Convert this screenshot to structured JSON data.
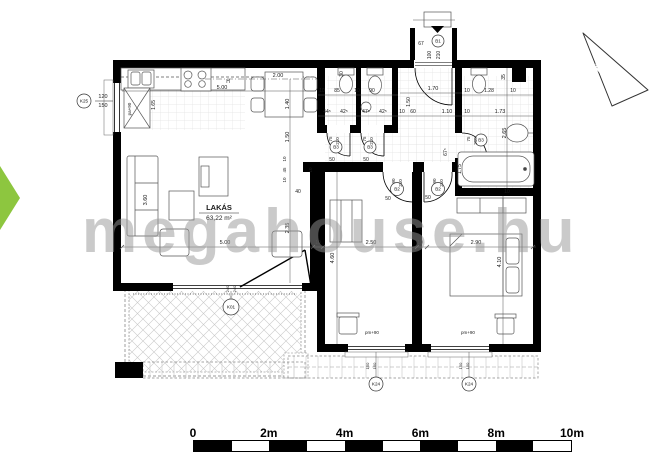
{
  "watermark": "megahouse.hu",
  "north": {
    "label": "É"
  },
  "colors": {
    "accent_green": "#8dc63f",
    "wall": "#000000",
    "watermark_gray": "#969696",
    "dim_text": "#1a1a1a"
  },
  "scale_bar": {
    "labels": [
      "0",
      "2m",
      "4m",
      "6m",
      "8m",
      "10m"
    ],
    "segments": 10
  },
  "ref_circles": [
    {
      "t": "B1",
      "x": 438,
      "y": 41,
      "rad": 6
    },
    {
      "t": "B3",
      "x": 336,
      "y": 147,
      "rad": 6
    },
    {
      "t": "B3",
      "x": 370,
      "y": 147,
      "rad": 6
    },
    {
      "t": "B3",
      "x": 481,
      "y": 140,
      "rad": 6
    },
    {
      "t": "B2",
      "x": 397,
      "y": 189,
      "rad": 6.5
    },
    {
      "t": "B2",
      "x": 438,
      "y": 189,
      "rad": 6.5
    },
    {
      "t": "K01",
      "x": 231,
      "y": 307,
      "rad": 8
    },
    {
      "t": "K24",
      "x": 376,
      "y": 384,
      "rad": 7
    },
    {
      "t": "K24",
      "x": 469,
      "y": 384,
      "rad": 7
    },
    {
      "t": "K25",
      "x": 84,
      "y": 101,
      "rad": 7
    }
  ],
  "annotations": [
    {
      "t": "2.00",
      "x": 278,
      "y": 77
    },
    {
      "t": "5.00",
      "x": 222,
      "y": 89
    },
    {
      "t": "H",
      "x": 228,
      "y": 83,
      "s": 5
    },
    {
      "t": "10",
      "x": 322,
      "y": 92,
      "s": 5
    },
    {
      "t": "85",
      "x": 337,
      "y": 92,
      "s": 5
    },
    {
      "t": "10",
      "x": 357,
      "y": 92,
      "s": 5
    },
    {
      "t": "90",
      "x": 372,
      "y": 92,
      "s": 5
    },
    {
      "t": "1.70",
      "x": 433,
      "y": 90
    },
    {
      "t": "10",
      "x": 467,
      "y": 92,
      "s": 5
    },
    {
      "t": "1.28",
      "x": 489,
      "y": 92,
      "s": 5
    },
    {
      "t": "10",
      "x": 513,
      "y": 92,
      "s": 5
    },
    {
      "t": "44⁵",
      "x": 327,
      "y": 113,
      "s": 5
    },
    {
      "t": "42⁵",
      "x": 344,
      "y": 113,
      "s": 5
    },
    {
      "t": "47⁵",
      "x": 366,
      "y": 113,
      "s": 5
    },
    {
      "t": "42⁵",
      "x": 383,
      "y": 113,
      "s": 5
    },
    {
      "t": "10",
      "x": 402,
      "y": 113,
      "s": 5
    },
    {
      "t": "60",
      "x": 413,
      "y": 113,
      "s": 5
    },
    {
      "t": "1.10",
      "x": 447,
      "y": 113
    },
    {
      "t": "10",
      "x": 467,
      "y": 113,
      "s": 5
    },
    {
      "t": "1.73",
      "x": 500,
      "y": 113
    },
    {
      "t": "67",
      "x": 421,
      "y": 45,
      "s": 5
    },
    {
      "t": "5.00",
      "x": 225,
      "y": 244
    },
    {
      "t": "10",
      "x": 318,
      "y": 244,
      "s": 5
    },
    {
      "t": "2.50",
      "x": 371,
      "y": 244
    },
    {
      "t": "10",
      "x": 420,
      "y": 244,
      "s": 5
    },
    {
      "t": "2.90",
      "x": 476,
      "y": 244
    },
    {
      "t": "40",
      "x": 298,
      "y": 193,
      "s": 5
    },
    {
      "t": "50",
      "x": 388,
      "y": 200,
      "s": 5
    },
    {
      "t": "50",
      "x": 428,
      "y": 199,
      "s": 5
    },
    {
      "t": "50",
      "x": 332,
      "y": 161,
      "s": 5
    },
    {
      "t": "50",
      "x": 366,
      "y": 161,
      "s": 5
    },
    {
      "t": "120",
      "x": 103,
      "y": 98,
      "s": 5.5
    },
    {
      "t": "150",
      "x": 103,
      "y": 107,
      "s": 5.5
    },
    {
      "t": "pm+90",
      "x": 372,
      "y": 334,
      "s": 4.5
    },
    {
      "t": "pm+90",
      "x": 468,
      "y": 334,
      "s": 4.5
    },
    {
      "t": "10",
      "x": 507,
      "y": 193,
      "s": 5
    },
    {
      "t": "LAKÁS",
      "x": 219,
      "y": 210,
      "s": 7.5,
      "b": 1
    },
    {
      "t": "63,22 m²",
      "x": 219,
      "y": 220,
      "s": 6.5
    },
    {
      "t": "1.40",
      "x": 289,
      "y": 104,
      "r": -90
    },
    {
      "t": "1.50",
      "x": 289,
      "y": 137,
      "r": -90
    },
    {
      "t": "10",
      "x": 286,
      "y": 159,
      "r": -90,
      "s": 4.5
    },
    {
      "t": "45",
      "x": 286,
      "y": 170,
      "r": -90,
      "s": 4.5
    },
    {
      "t": "10",
      "x": 286,
      "y": 180,
      "r": -90,
      "s": 4.5
    },
    {
      "t": "2.35",
      "x": 289,
      "y": 228,
      "r": -90
    },
    {
      "t": "3.60",
      "x": 147,
      "y": 200,
      "r": -90
    },
    {
      "t": "1.65",
      "x": 155,
      "y": 105,
      "r": -90,
      "s": 5
    },
    {
      "t": "pa+90",
      "x": 131,
      "y": 109,
      "r": -90,
      "s": 4.5
    },
    {
      "t": "30",
      "x": 343,
      "y": 74,
      "r": -90,
      "s": 5
    },
    {
      "t": "1.50",
      "x": 410,
      "y": 102,
      "r": -90,
      "s": 5
    },
    {
      "t": "35",
      "x": 505,
      "y": 77,
      "r": -90,
      "s": 5
    },
    {
      "t": "2.65",
      "x": 506,
      "y": 133,
      "r": -90
    },
    {
      "t": "1.75",
      "x": 461,
      "y": 169,
      "r": -90,
      "s": 5
    },
    {
      "t": "67⁵",
      "x": 447,
      "y": 152,
      "r": -90,
      "s": 5
    },
    {
      "t": "4.60",
      "x": 334,
      "y": 258,
      "r": -90
    },
    {
      "t": "4.10",
      "x": 501,
      "y": 262,
      "r": -90
    },
    {
      "t": "100",
      "x": 431,
      "y": 55,
      "r": -90,
      "s": 5
    },
    {
      "t": "210",
      "x": 440,
      "y": 55,
      "r": -90,
      "s": 5
    },
    {
      "t": "75",
      "x": 332,
      "y": 139,
      "r": -90,
      "s": 4.5
    },
    {
      "t": "210",
      "x": 339,
      "y": 141,
      "r": -90,
      "s": 4.5
    },
    {
      "t": "75",
      "x": 366,
      "y": 139,
      "r": -90,
      "s": 4.5
    },
    {
      "t": "210",
      "x": 373,
      "y": 141,
      "r": -90,
      "s": 4.5
    },
    {
      "t": "75",
      "x": 470,
      "y": 139,
      "r": -90,
      "s": 4.5
    },
    {
      "t": "210",
      "x": 477,
      "y": 141,
      "r": -90,
      "s": 4.5
    },
    {
      "t": "90",
      "x": 395,
      "y": 181,
      "r": -90,
      "s": 4.5
    },
    {
      "t": "210",
      "x": 402,
      "y": 183,
      "r": -90,
      "s": 4.5
    },
    {
      "t": "90",
      "x": 436,
      "y": 181,
      "r": -90,
      "s": 4.5
    },
    {
      "t": "210",
      "x": 443,
      "y": 183,
      "r": -90,
      "s": 4.5
    },
    {
      "t": "150",
      "x": 369,
      "y": 366,
      "r": -90,
      "s": 4
    },
    {
      "t": "150",
      "x": 376,
      "y": 366,
      "r": -90,
      "s": 4
    },
    {
      "t": "150",
      "x": 462,
      "y": 366,
      "r": -90,
      "s": 4
    },
    {
      "t": "150",
      "x": 469,
      "y": 366,
      "r": -90,
      "s": 4
    },
    {
      "t": "240",
      "x": 229,
      "y": 289,
      "r": -90,
      "s": 4
    },
    {
      "t": "240",
      "x": 236,
      "y": 289,
      "r": -90,
      "s": 4
    },
    {
      "t": "10",
      "x": 312,
      "y": 170,
      "r": -90,
      "s": 4.5
    }
  ]
}
